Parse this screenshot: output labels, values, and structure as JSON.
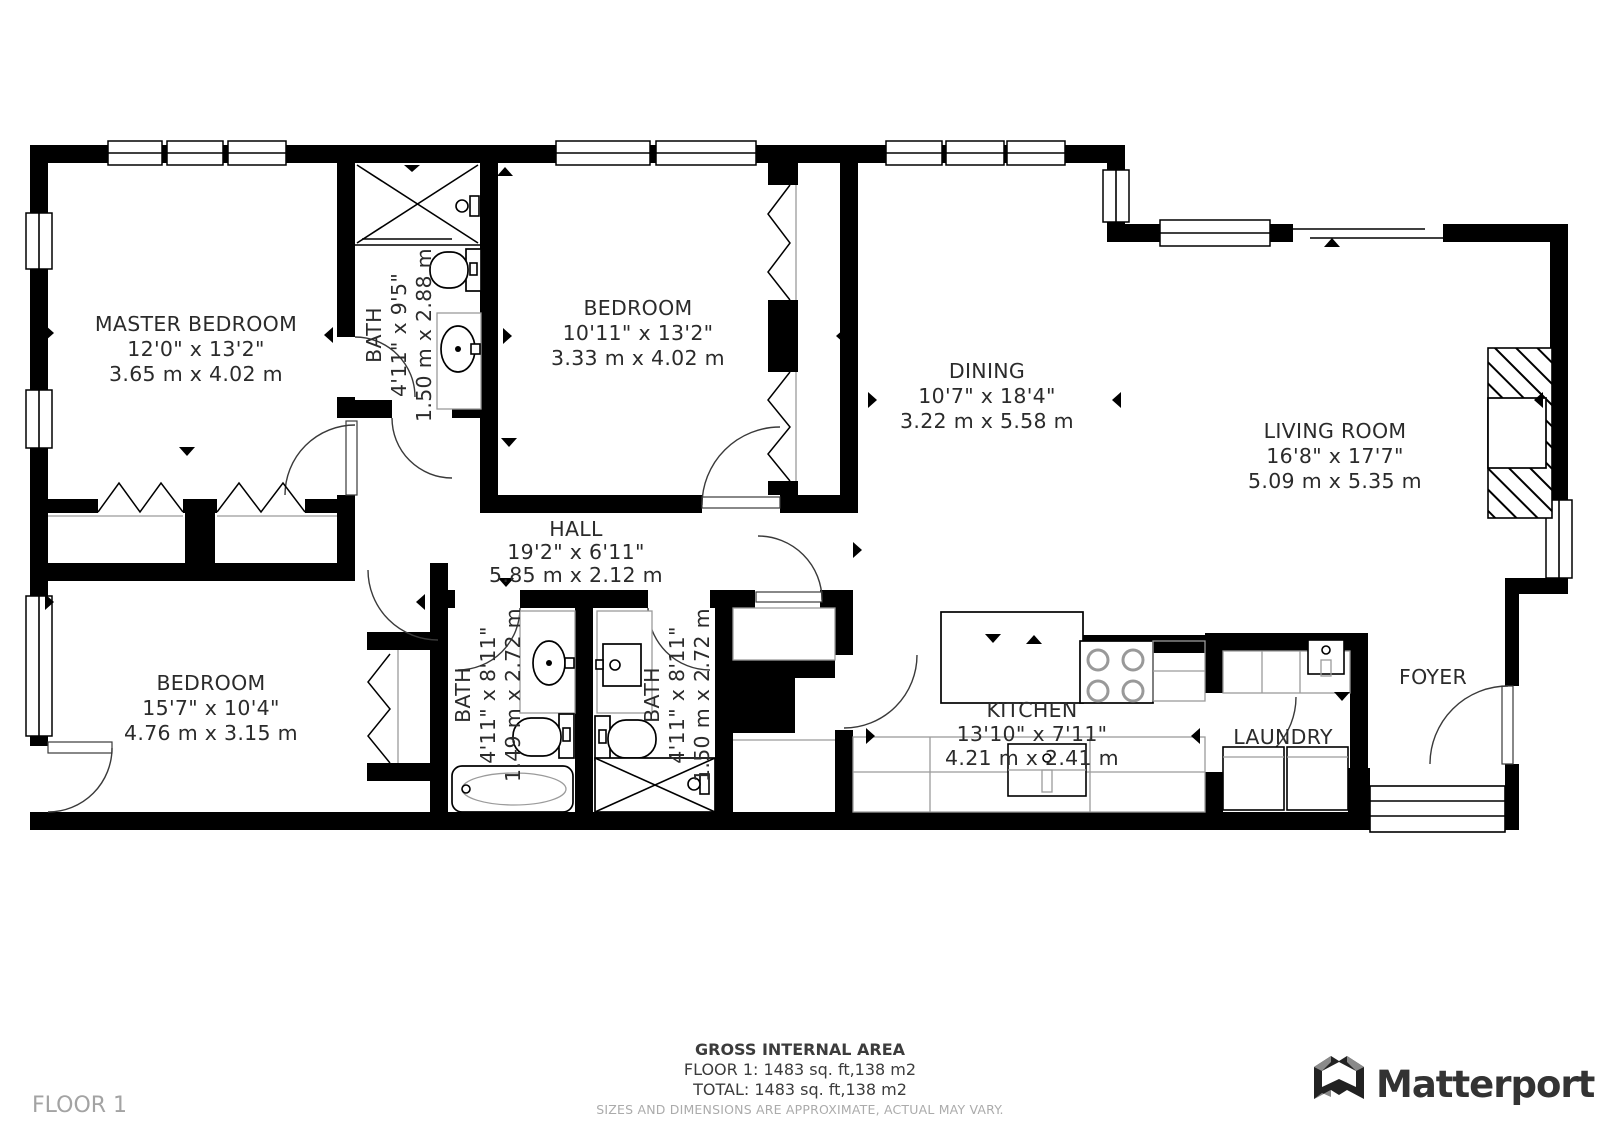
{
  "floor_label": "FLOOR 1",
  "footer": {
    "area_title": "GROSS INTERNAL AREA",
    "floor_line": "FLOOR 1: 1483 sq. ft,138 m2",
    "total_line": "TOTAL: 1483 sq. ft,138 m2",
    "disclaimer": "SIZES AND DIMENSIONS ARE APPROXIMATE, ACTUAL MAY VARY."
  },
  "brand": {
    "name": "Matterport"
  },
  "rooms": {
    "master_bedroom": {
      "name": "MASTER BEDROOM",
      "imperial": "12'0\" x 13'2\"",
      "metric": "3.65 m x 4.02 m"
    },
    "master_bath": {
      "name": "BATH",
      "imperial": "4'11\" x 9'5\"",
      "metric": "1.50 m x 2.88 m"
    },
    "bedroom_top": {
      "name": "BEDROOM",
      "imperial": "10'11\" x 13'2\"",
      "metric": "3.33 m x 4.02 m"
    },
    "dining": {
      "name": "DINING",
      "imperial": "10'7\" x 18'4\"",
      "metric": "3.22 m x 5.58 m"
    },
    "living_room": {
      "name": "LIVING ROOM",
      "imperial": "16'8\" x 17'7\"",
      "metric": "5.09 m x 5.35 m"
    },
    "hall": {
      "name": "HALL",
      "imperial": "19'2\" x 6'11\"",
      "metric": "5.85 m x 2.12 m"
    },
    "bedroom_bottom": {
      "name": "BEDROOM",
      "imperial": "15'7\" x 10'4\"",
      "metric": "4.76 m x 3.15 m"
    },
    "bath_left": {
      "name": "BATH",
      "imperial": "4'11\" x 8'11\"",
      "metric": "1.49 m x 2.72 m"
    },
    "bath_right": {
      "name": "BATH",
      "imperial": "4'11\" x 8'11\"",
      "metric": "1.50 m x 2.72 m"
    },
    "kitchen": {
      "name": "KITCHEN",
      "imperial": "13'10\" x 7'11\"",
      "metric": "4.21 m x 2.41 m"
    },
    "laundry": {
      "name": "LAUNDRY"
    },
    "foyer": {
      "name": "FOYER"
    }
  },
  "colors": {
    "wall": "#000000",
    "background": "#ffffff",
    "label_text": "#2b2b2b",
    "muted_text": "#a6a6a6",
    "logo_text": "#333333"
  }
}
